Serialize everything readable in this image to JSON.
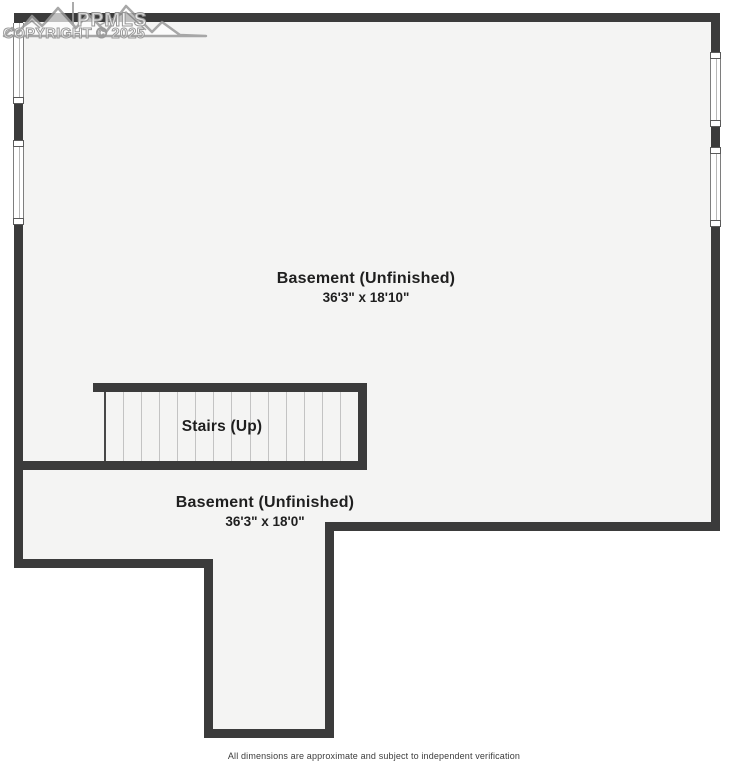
{
  "watermark": {
    "logo_icon": "mountain-range-icon",
    "brand": "PPMLS",
    "copyright": "COPYRIGHT © 2025"
  },
  "floorplan": {
    "rooms": [
      {
        "label": "Basement (Unfinished)",
        "dimensions": "36'3\" x 18'10\""
      },
      {
        "label": "Basement (Unfinished)",
        "dimensions": "36'3\" x 18'0\""
      }
    ],
    "stairs": {
      "label": "Stairs (Up)",
      "tread_count": 13
    },
    "colors": {
      "wall": "#3b3b3b",
      "floor": "#f4f4f3",
      "background": "#ffffff",
      "tread_line": "#c3c3c3",
      "label_text": "#1f1f1f"
    }
  },
  "footer": {
    "disclaimer": "All dimensions are approximate and subject to independent verification"
  }
}
